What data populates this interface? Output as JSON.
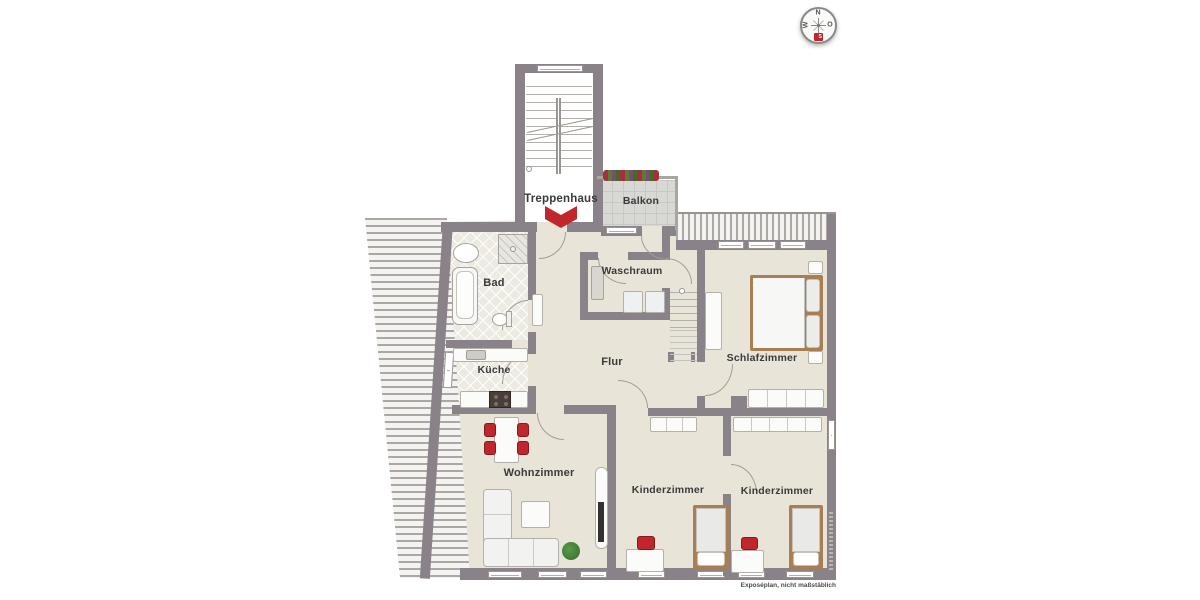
{
  "rooms": {
    "treppenhaus": "Treppenhaus",
    "balkon": "Balkon",
    "bad": "Bad",
    "waschraum": "Waschraum",
    "kueche": "Küche",
    "flur": "Flur",
    "schlafzimmer": "Schlafzimmer",
    "wohnzimmer": "Wohnzimmer",
    "kinderzimmer_1": "Kinderzimmer",
    "kinderzimmer_2": "Kinderzimmer"
  },
  "compass": {
    "n": "N",
    "o": "O",
    "s": "S",
    "w": "W"
  },
  "footnote": "Exposéplan, nicht maßstäblich",
  "colors": {
    "wall": "#8a8289",
    "floor": "#e9e4d8",
    "bad_floor": "#edeae2",
    "balcony_floor": "#d8d8d5",
    "accent_red": "#c0262c",
    "bed_frame": "#a87f55",
    "plant_green": "#3e7a35",
    "furniture_border": "#b5b0a9",
    "hatch_line": "#aba7a3",
    "text": "#3a3a3a"
  }
}
